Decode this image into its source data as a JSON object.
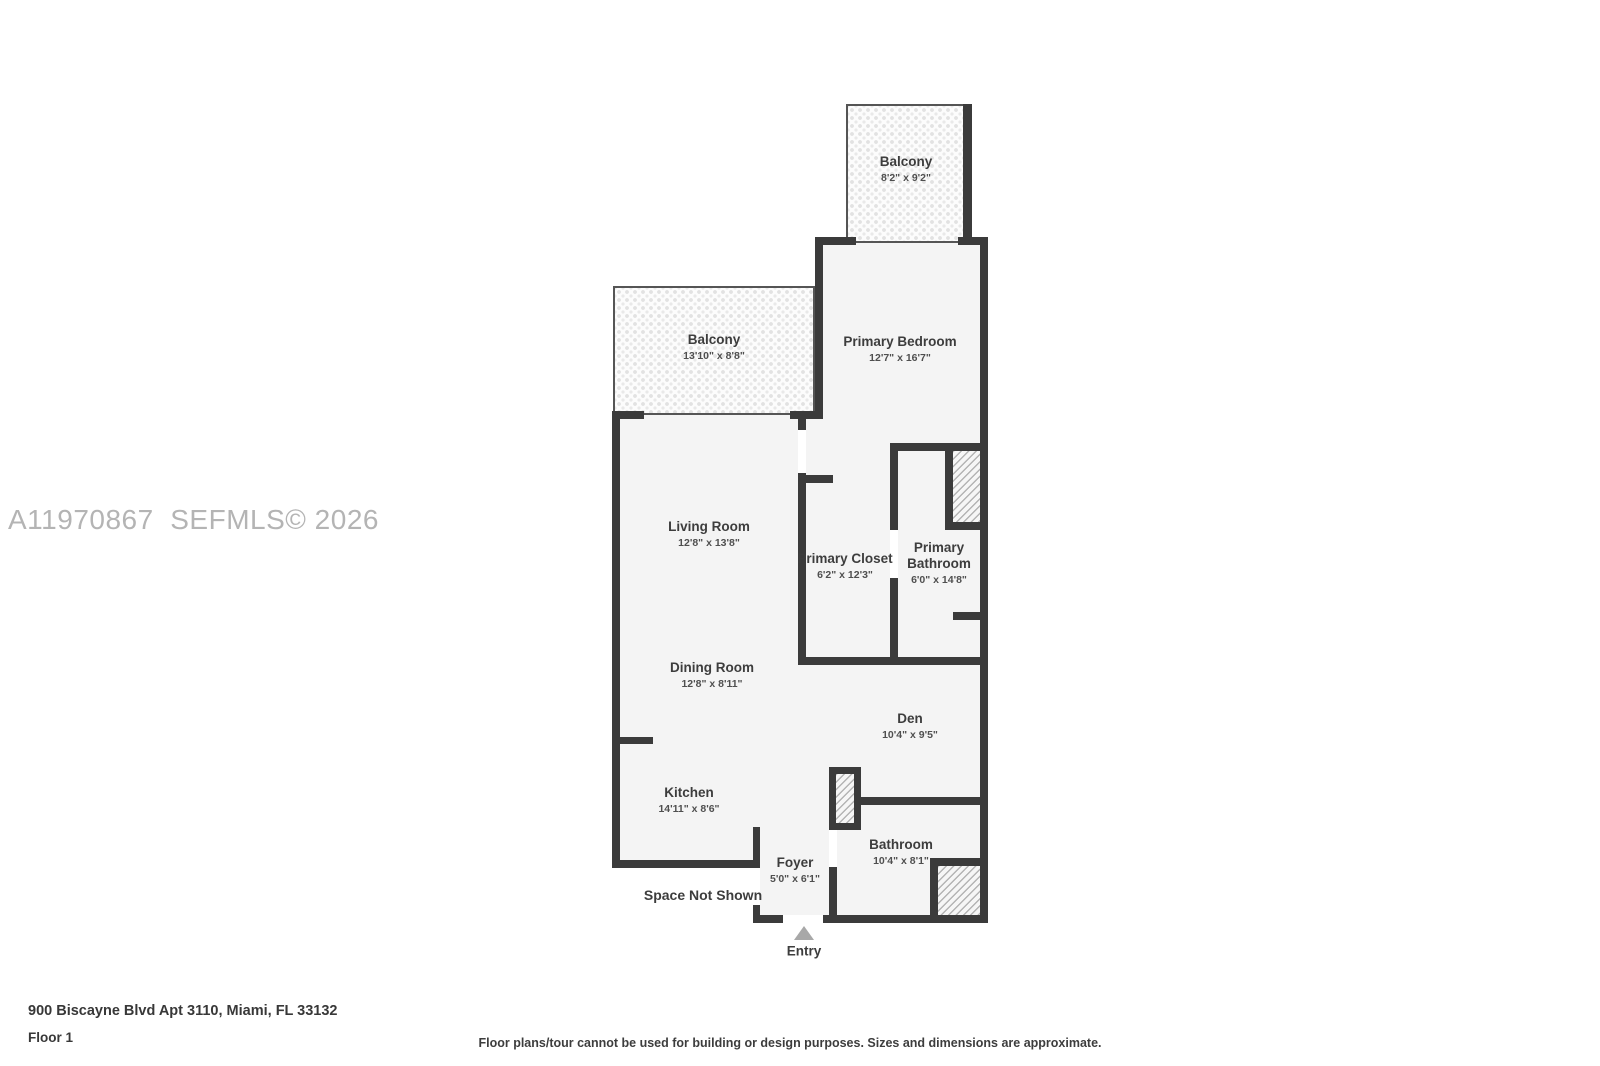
{
  "watermark": "A11970867  SEFMLS© 2026",
  "address_line": "900 Biscayne Blvd Apt 3110, Miami, FL 33132",
  "floor_label": "Floor 1",
  "disclaimer": "Floor plans/tour cannot be used for building or design purposes. Sizes and dimensions are approximate.",
  "labels": {
    "entry": "Entry",
    "space_not_shown": "Space Not Shown"
  },
  "colors": {
    "wall": "#3b3b3b",
    "room_fill": "#f4f4f4",
    "watermark": "#b4b4b4",
    "label_text": "#3d3d3d",
    "entry_arrow": "#a8a8a8"
  },
  "rooms": [
    {
      "name": "Balcony",
      "dims": "8'2\" x 9'2\""
    },
    {
      "name": "Primary Bedroom",
      "dims": "12'7\" x 16'7\""
    },
    {
      "name": "Balcony",
      "dims": "13'10\" x 8'8\""
    },
    {
      "name": "Living Room",
      "dims": "12'8\" x 13'8\""
    },
    {
      "name": "Primary Closet",
      "dims": "6'2\" x 12'3\""
    },
    {
      "name": "Primary Bathroom",
      "dims": "6'0\" x 14'8\""
    },
    {
      "name": "Dining Room",
      "dims": "12'8\" x 8'11\""
    },
    {
      "name": "Den",
      "dims": "10'4\" x 9'5\""
    },
    {
      "name": "Kitchen",
      "dims": "14'11\" x 8'6\""
    },
    {
      "name": "Foyer",
      "dims": "5'0\" x 6'1\""
    },
    {
      "name": "Bathroom",
      "dims": "10'4\" x 8'1\""
    }
  ]
}
